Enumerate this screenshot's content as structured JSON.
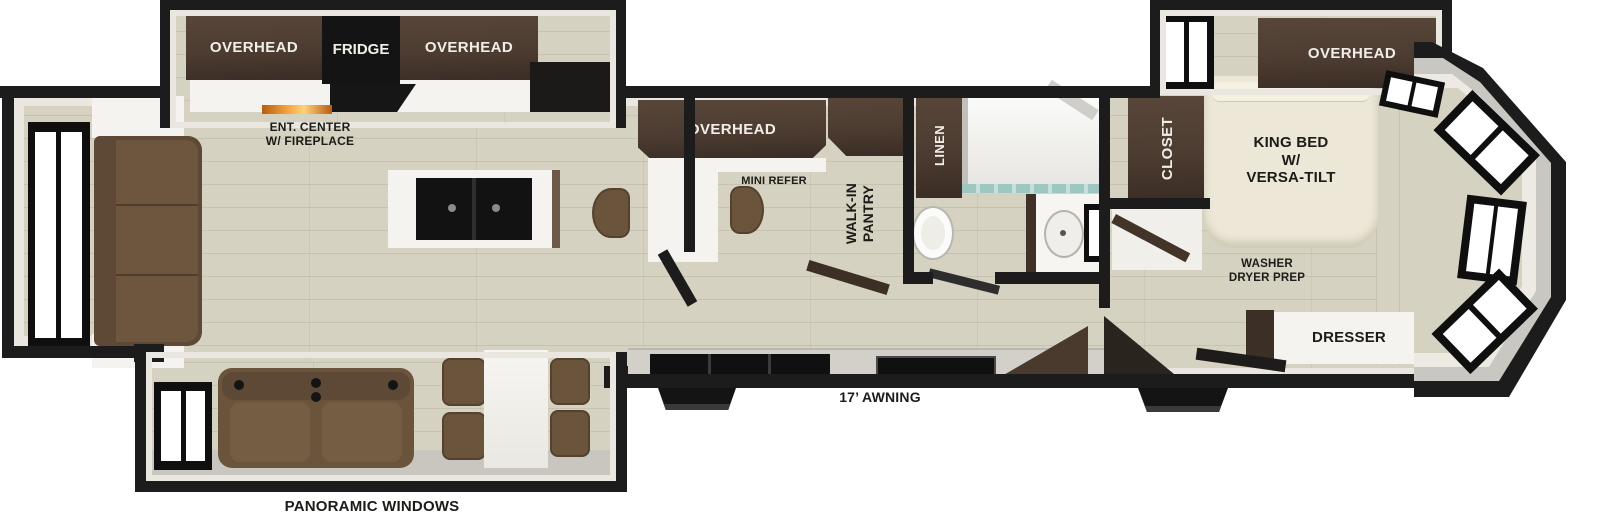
{
  "floorplan": {
    "kind": "RV fifth-wheel floor plan (top view)",
    "labels": {
      "overhead": "OVERHEAD",
      "fridge": "FRIDGE",
      "ent_center_1": "ENT. CENTER",
      "ent_center_2": "W/ FIREPLACE",
      "mini_refer": "MINI REFER",
      "walk_in_1": "WALK-IN",
      "walk_in_2": "PANTRY",
      "linen": "LINEN",
      "closet": "CLOSET",
      "king_bed_1": "KING BED",
      "king_bed_2": "W/",
      "king_bed_3": "VERSA-TILT",
      "washer_1": "WASHER",
      "washer_2": "DRYER PREP",
      "dresser": "DRESSER",
      "awning": "17’ AWNING",
      "panoramic": "PANORAMIC WINDOWS"
    },
    "furniture": [
      "rear sofa with end tables",
      "kitchen island with double sink",
      "counter stools",
      "entertainment center with fireplace",
      "refrigerator",
      "mini refrigerator",
      "range cooktop",
      "theater seating",
      "dining table with four chairs",
      "walk-in pantry",
      "linen cabinet",
      "shower",
      "toilet",
      "bathroom vanity sink",
      "bedroom closet",
      "king bed",
      "dresser",
      "washer dryer prep cabinet",
      "two entry steps",
      "panoramic windows",
      "front cap windows"
    ],
    "colors": {
      "wall": "#1c1c1c",
      "floor": "#d6d2c1",
      "cabinet": "#4d3c31",
      "counter": "#f4f3f0",
      "lining": "#e9e7e0",
      "gray": "#c8c6bf",
      "seat": "#6b543c",
      "bed": "#ece7d7",
      "glass": "#9ec7c1",
      "fire": "#e2892b"
    }
  }
}
